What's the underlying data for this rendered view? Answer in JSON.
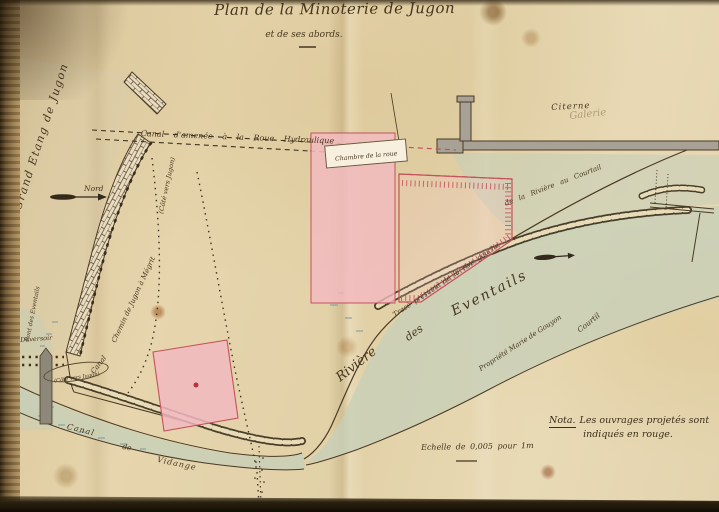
{
  "title": "Plan de la Minoterie de Jugon",
  "subtitle": "et de ses abords.",
  "compass": {
    "north_label": "Nord"
  },
  "water": {
    "grand_etang": "Grand Etang de Jugon",
    "riviere": "Rivière",
    "riviere_des": "des",
    "riviere_eventails": "Eventails",
    "canal_vidange_1": "Canal",
    "canal_vidange_2": "de",
    "canal_vidange_3": "Vidange"
  },
  "structures": {
    "canal_amenee": "Canal d'amenée à la Roue Hydraulique",
    "chambre_roue": "Chambre de la roue",
    "citerne": "Citerne",
    "galerie_pencil": "Galerie",
    "deversoir": "Déversoir",
    "pont_eventails": "Pont des Eventails",
    "canal": "Canal"
  },
  "roads": {
    "chemin_jugon": "Chemin de Jugon à Mégrit",
    "cote_vers_jugon": "(Côté vers Jugon)",
    "cote_vers_jugon_2": "(Côté vers Jugon)",
    "trace_1": "Tracé présumé de la rive gauche",
    "trace_2": "de la Rivière au Courtail"
  },
  "properties": {
    "propriete": "Propriété Marie de Gouyon",
    "courtil": "Courtil"
  },
  "note": {
    "heading": "Nota.",
    "line1": "Les ouvrages projetés sont",
    "line2": "indiqués en rouge."
  },
  "scale_text": "Echelle de 0,005 pour 1m",
  "colors": {
    "projected_red": "#c4525c",
    "pink_fill": "#f2b9c0",
    "water": "#c7cfb8",
    "ink": "#46361f",
    "paper": "#e3d2a8"
  }
}
